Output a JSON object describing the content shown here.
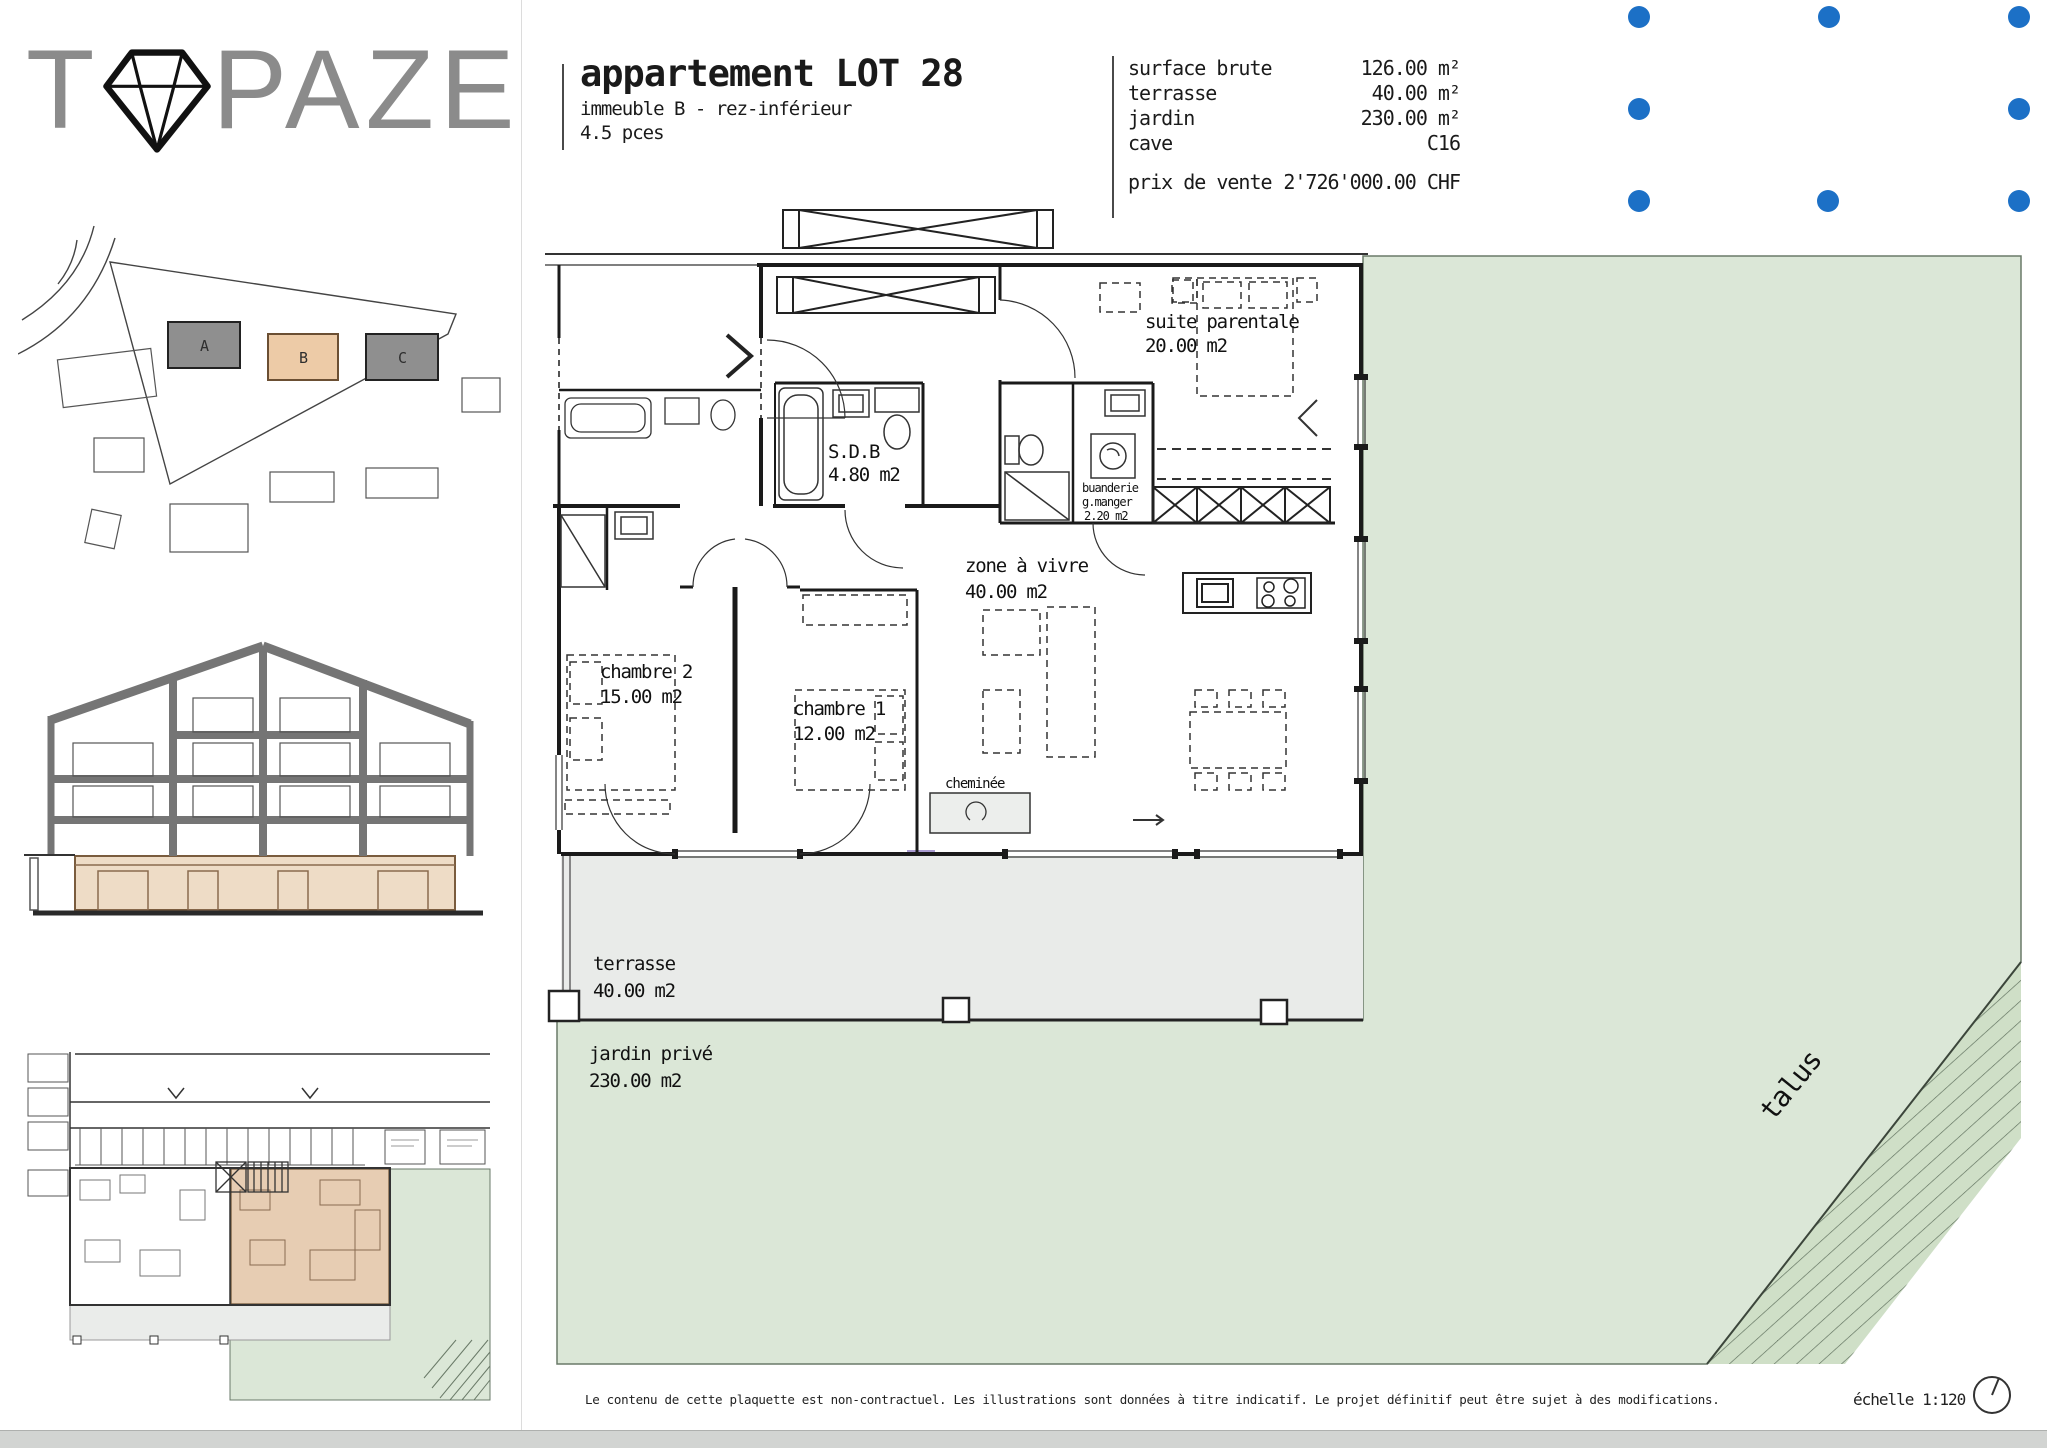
{
  "colors": {
    "accent_blue": "#1c70c6",
    "garden_green": "#dbe7d7",
    "talus_green": "#cfdfc7",
    "terrace_gray": "#e9ebe9",
    "unit_tan": "#e7cdb3",
    "section_beige": "#eedcc6",
    "site_gray": "#8f8f8f",
    "site_tan": "#edcba7",
    "logo_gray": "#8b8b8b"
  },
  "logo": {
    "t": "T",
    "rest": "PAZE"
  },
  "header": {
    "title": "appartement LOT 28",
    "subtitle": "immeuble B - rez-inférieur",
    "pieces": "4.5 pces"
  },
  "pricing": {
    "rows": [
      {
        "label": "surface brute",
        "value": "126.00 m²"
      },
      {
        "label": "terrasse",
        "value": "40.00 m²"
      },
      {
        "label": "jardin",
        "value": "230.00 m²"
      },
      {
        "label": "cave",
        "value": "C16"
      }
    ],
    "price_label": "prix de vente",
    "price_value": "2'726'000.00 CHF"
  },
  "site_plan": {
    "building_a": "A",
    "building_b": "B",
    "building_c": "C"
  },
  "plan": {
    "suite_name": "suite parentale",
    "suite_area": "20.00 m2",
    "sdb_name": "S.D.B",
    "sdb_area": "4.80 m2",
    "buanderie_l1": "buanderie",
    "buanderie_l2": "g.manger",
    "buanderie_l3": "2.20 m2",
    "zone_name": "zone à vivre",
    "zone_area": "40.00 m2",
    "chambre2_name": "chambre 2",
    "chambre2_area": "15.00 m2",
    "chambre1_name": "chambre 1",
    "chambre1_area": "12.00 m2",
    "cheminee": "cheminée",
    "terrasse_name": "terrasse",
    "terrasse_area": "40.00 m2",
    "jardin_name": "jardin privé",
    "jardin_area": "230.00 m2",
    "talus": "talus"
  },
  "footer": {
    "disclaimer": "Le contenu de cette plaquette est non-contractuel. Les illustrations sont données à titre indicatif. Le projet définitif peut être sujet à des modifications.",
    "scale": "échelle 1:120"
  }
}
